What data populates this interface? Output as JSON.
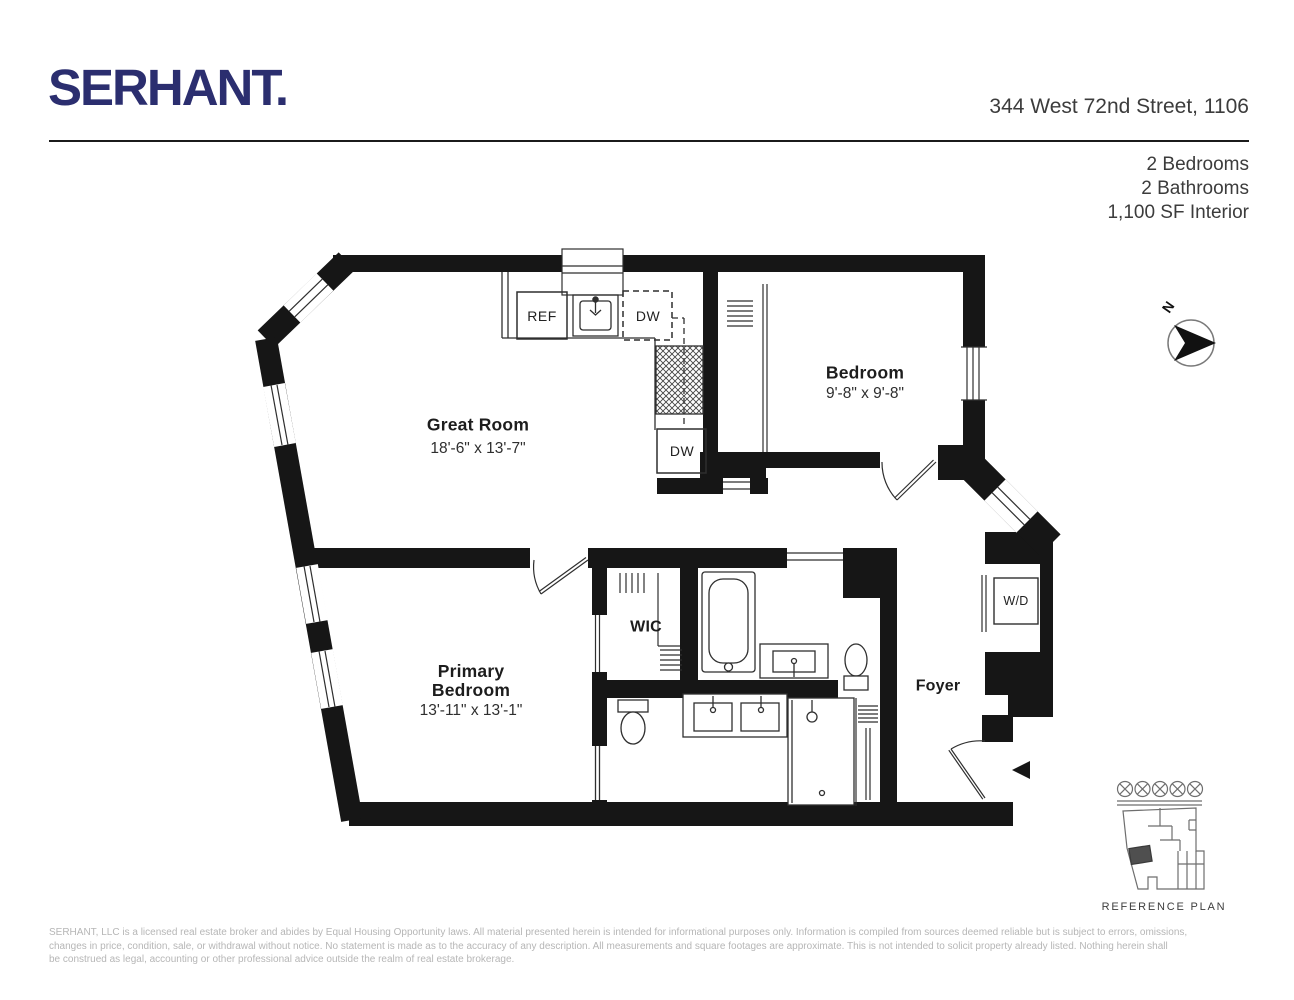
{
  "header": {
    "logo_text": "SERHANT.",
    "brand_color": "#2b2e6f",
    "address": "344 West 72nd Street, 1106",
    "stats": [
      "2 Bedrooms",
      "2 Bathrooms",
      "1,100 SF Interior"
    ]
  },
  "plan": {
    "wall_color": "#161616",
    "labels": {
      "great_room": {
        "name": "Great Room",
        "dims": "18'-6\" x 13'-7\""
      },
      "bedroom": {
        "name": "Bedroom",
        "dims": "9'-8\" x 9'-8\""
      },
      "primary_bedroom": {
        "name": "Primary Bedroom",
        "dims": "13'-11\" x 13'-1\""
      },
      "wic": "WIC",
      "foyer": "Foyer",
      "wd": "W/D",
      "ref": "REF",
      "dw_upper": "DW",
      "dw_lower": "DW"
    },
    "compass": {
      "label": "N"
    }
  },
  "reference_plan": {
    "caption": "REFERENCE PLAN"
  },
  "footer": {
    "disclaimer_color": "#b6b6b6",
    "lines": [
      "SERHANT, LLC is a licensed real estate broker and abides by Equal Housing Opportunity laws. All material presented herein is intended for informational purposes only. Information is compiled from sources deemed reliable but is subject to errors, omissions,",
      "changes in price, condition, sale, or withdrawal without notice. No statement is made as to the accuracy of any description. All measurements and square footages are approximate. This is not intended to solicit property already listed. Nothing herein shall",
      "be construed as legal, accounting or other professional advice outside the realm of real estate brokerage."
    ]
  }
}
